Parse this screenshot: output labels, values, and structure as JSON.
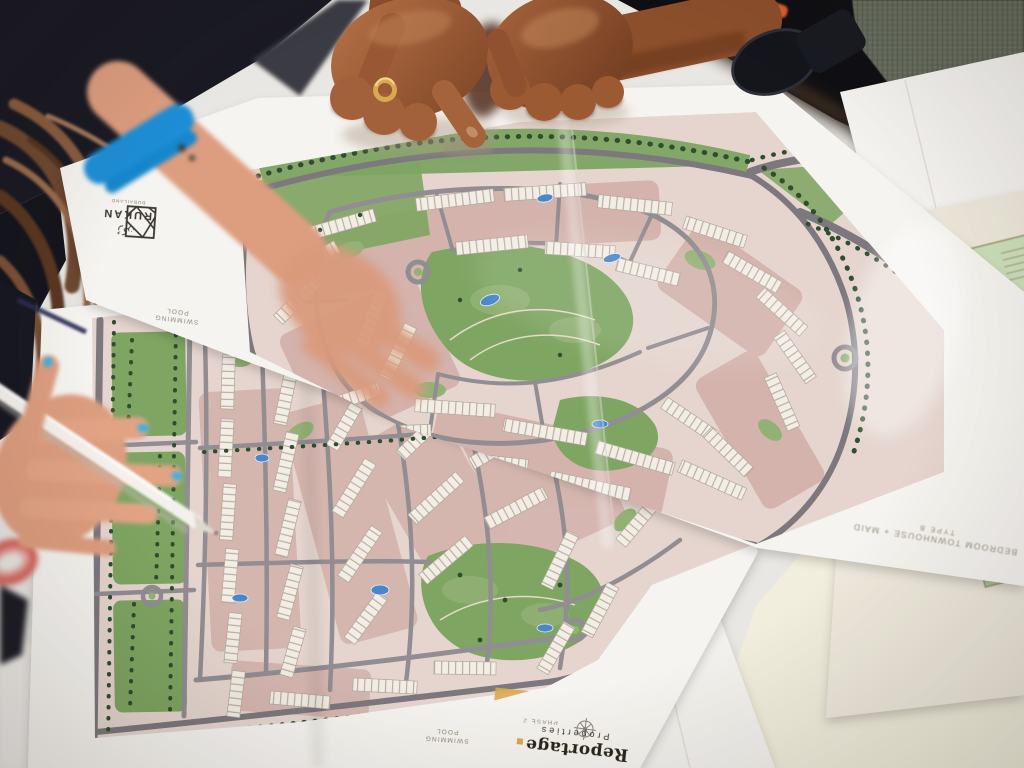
{
  "scene": {
    "type": "photograph",
    "description": "Overhead photo of hands pointing at folded residential master-plan site maps spread on a table during a property sales meeting"
  },
  "documents": {
    "upper_sitemap": {
      "brand": "RUKAN",
      "brand_arabic": "رُكن",
      "brand_tagline": "DUBAILAND",
      "margin_label_line1": "SWIMMING",
      "margin_label_line2": "POOL"
    },
    "lower_sitemap": {
      "margin_label_line1": "SWIMMING",
      "margin_label_line2": "POOL",
      "phase_label": "PHASE 2",
      "developer_wordmark": "Reportage",
      "developer_wordmark_sub": "Properties"
    },
    "floorplan_brochure": {
      "unit_count": "5",
      "title": "BEDROOM TOWNHOUSE + MAID",
      "subtitle": "TYPE B"
    }
  },
  "colors": {
    "paper": "#f6f4f0",
    "table": "#e9e7e3",
    "table_cream": "#f1eedd",
    "dark_clothing": "#1a1a24",
    "dark_clothing_2": "#0f0f14",
    "tweed_jacket": "#656b5e",
    "hair_brown": "#7a5138",
    "skin_man": "#9c5e39",
    "skin_man_shadow": "#6f3c21",
    "skin_woman": "#dd9d7f",
    "nail_polish_blue": "#2ba4dc",
    "wristband_blue": "#1e8ed6",
    "map_road": "#918d92",
    "map_road_dark": "#7c787d",
    "map_block_pink": "#c89d97",
    "map_green": "#7ea562",
    "map_tree": "#2e4e2e",
    "map_building": "#f3eee5",
    "map_pool": "#4a86c8",
    "map_base": "#e5d5ce",
    "gold_accent": "#d8a94e",
    "ink_brand": "#29251b",
    "label_gray": "#8d8779",
    "pen_white": "#f4f1ec"
  }
}
